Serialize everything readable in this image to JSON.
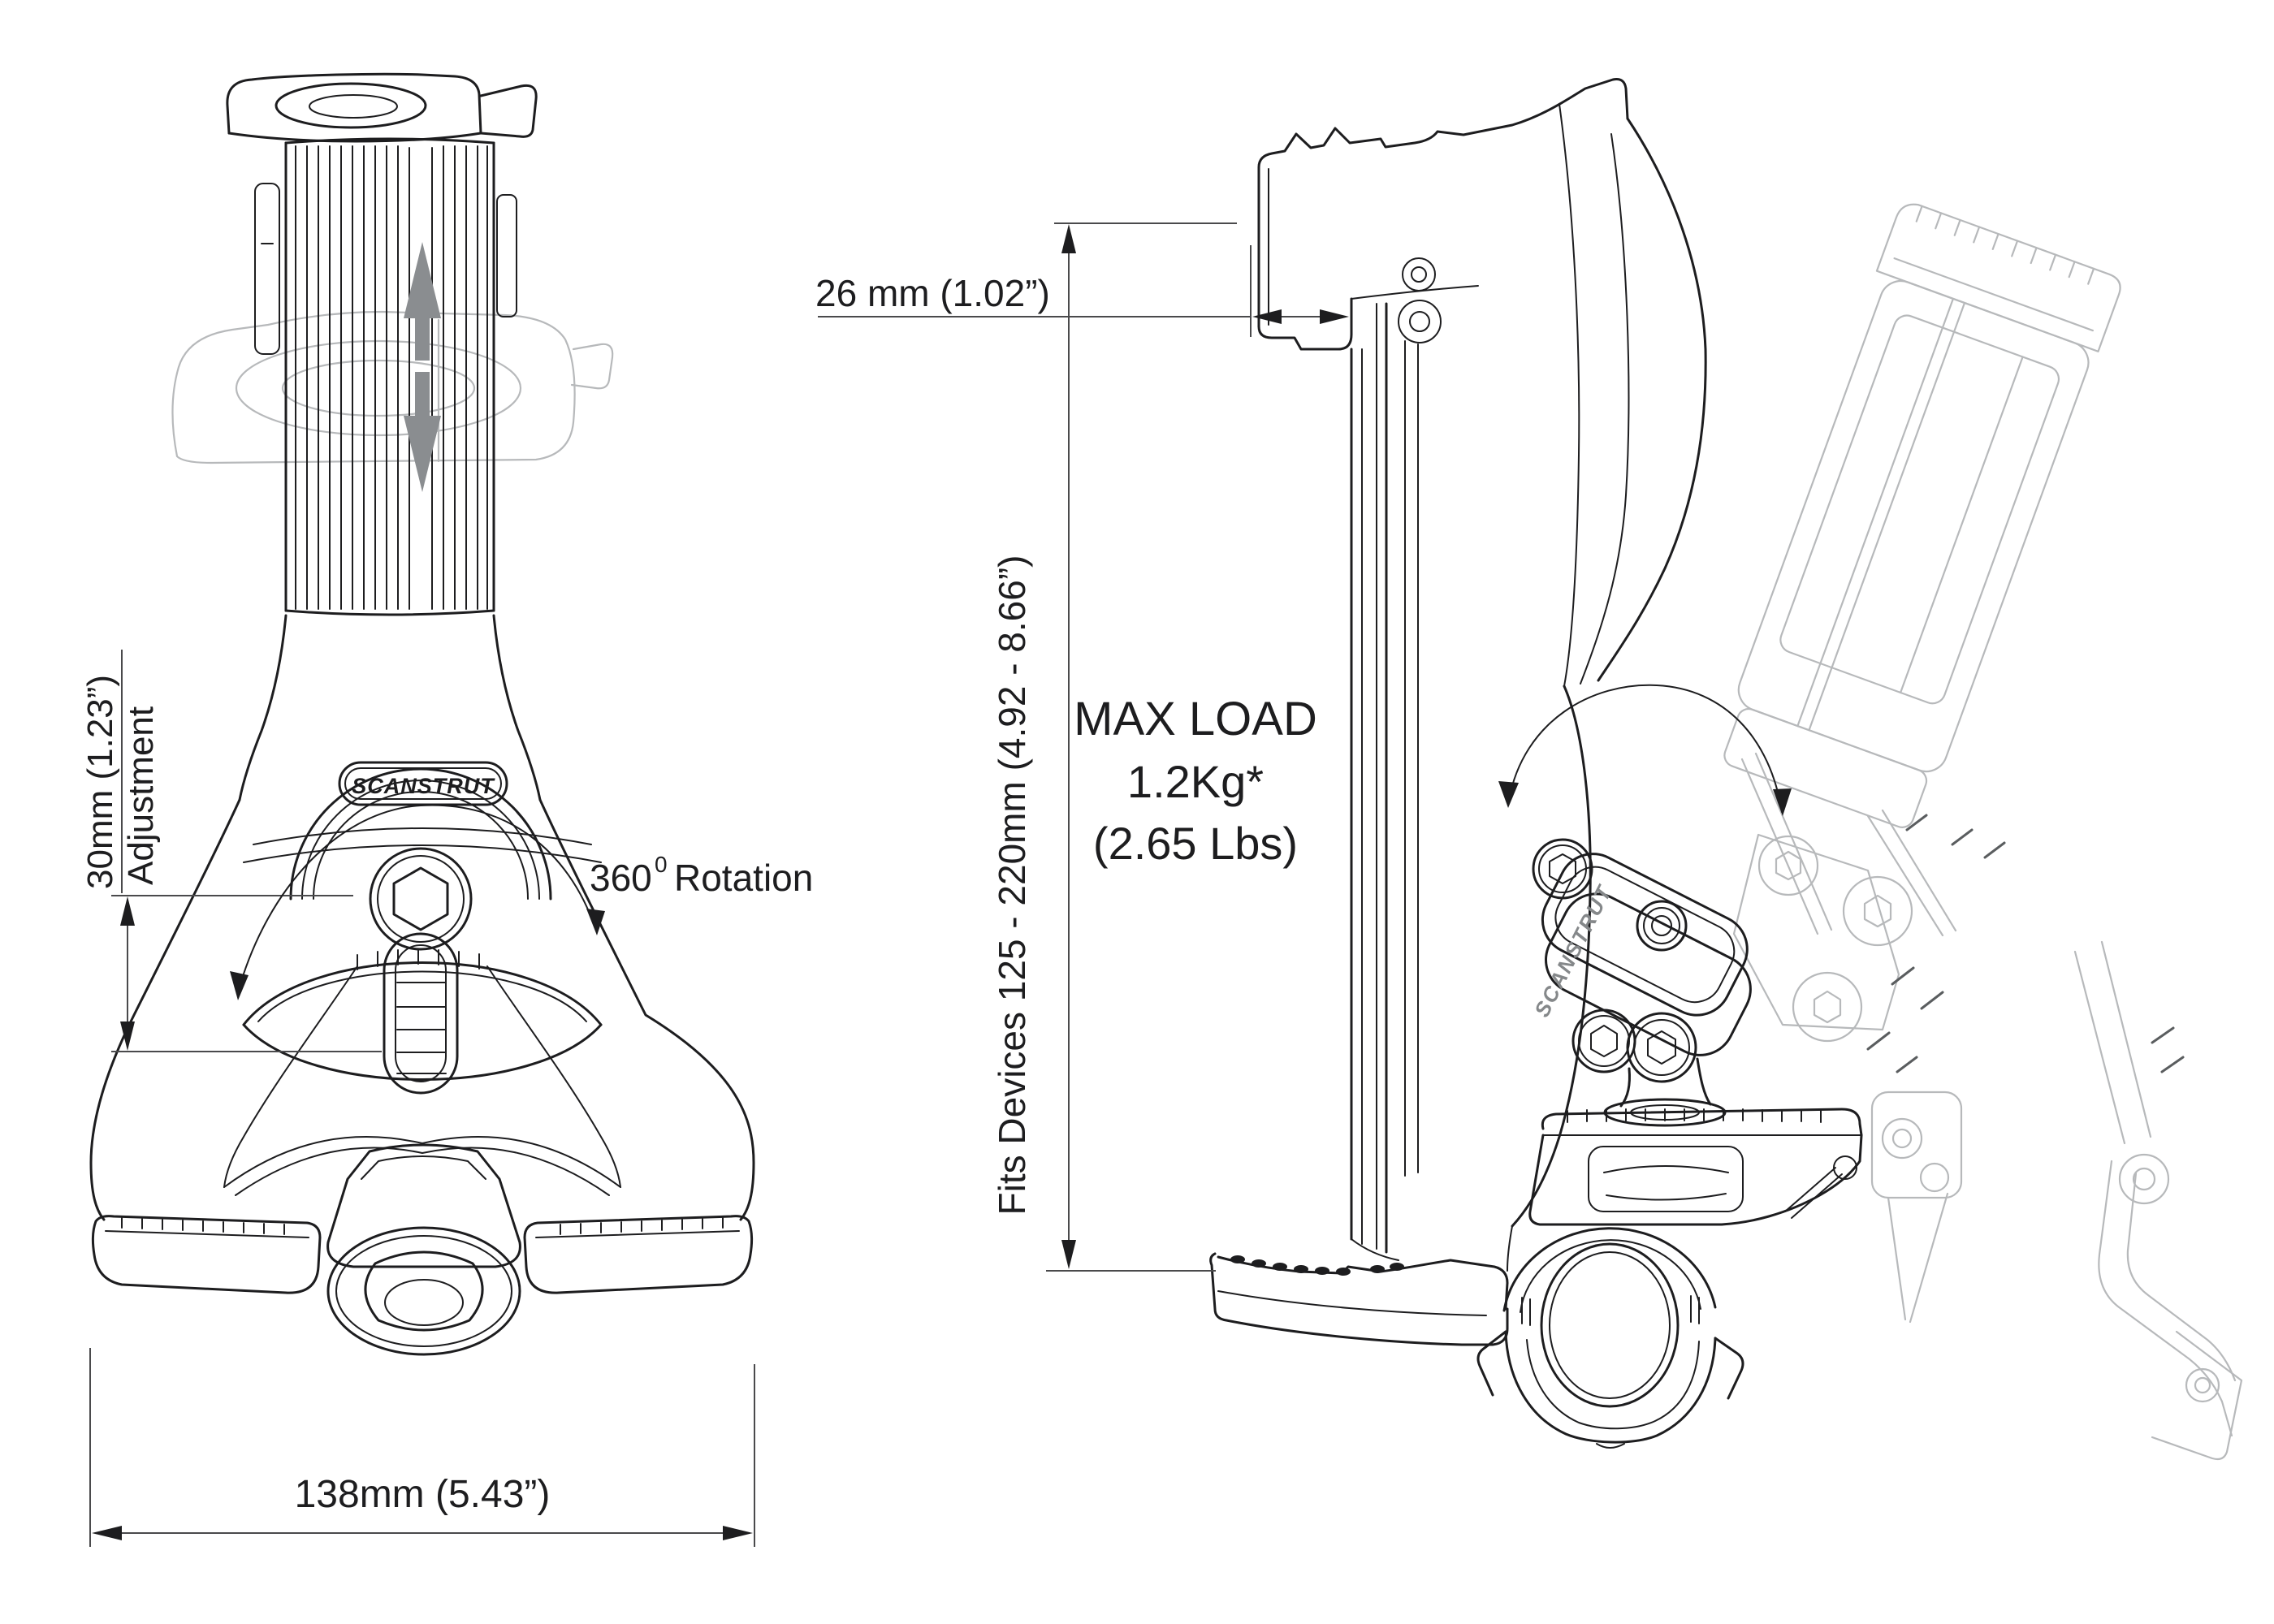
{
  "drawing": {
    "brand": "SCANSTRUT",
    "front_view": {
      "adjustment_dim": "30mm (1.23”)",
      "adjustment_label": "Adjustment",
      "rotation_value": "360",
      "rotation_sup": "0",
      "rotation_label": "Rotation",
      "width_dim": "138mm (5.43”)"
    },
    "side_view": {
      "depth_dim": "26 mm (1.02”)",
      "device_range": "Fits Devices 125 - 220mm (4.92 - 8.66”)",
      "max_load": {
        "line1": "MAX LOAD",
        "line2": "1.2Kg*",
        "line3": "(2.65 Lbs)"
      }
    },
    "iso_view": {
      "brand_emboss": "SCANSTRUT"
    },
    "colors": {
      "line": "#1d1d1f",
      "ghost": "#b7b9bb",
      "dimension": "#4a4a4c",
      "arrow_gray": "#8a8d90"
    }
  }
}
